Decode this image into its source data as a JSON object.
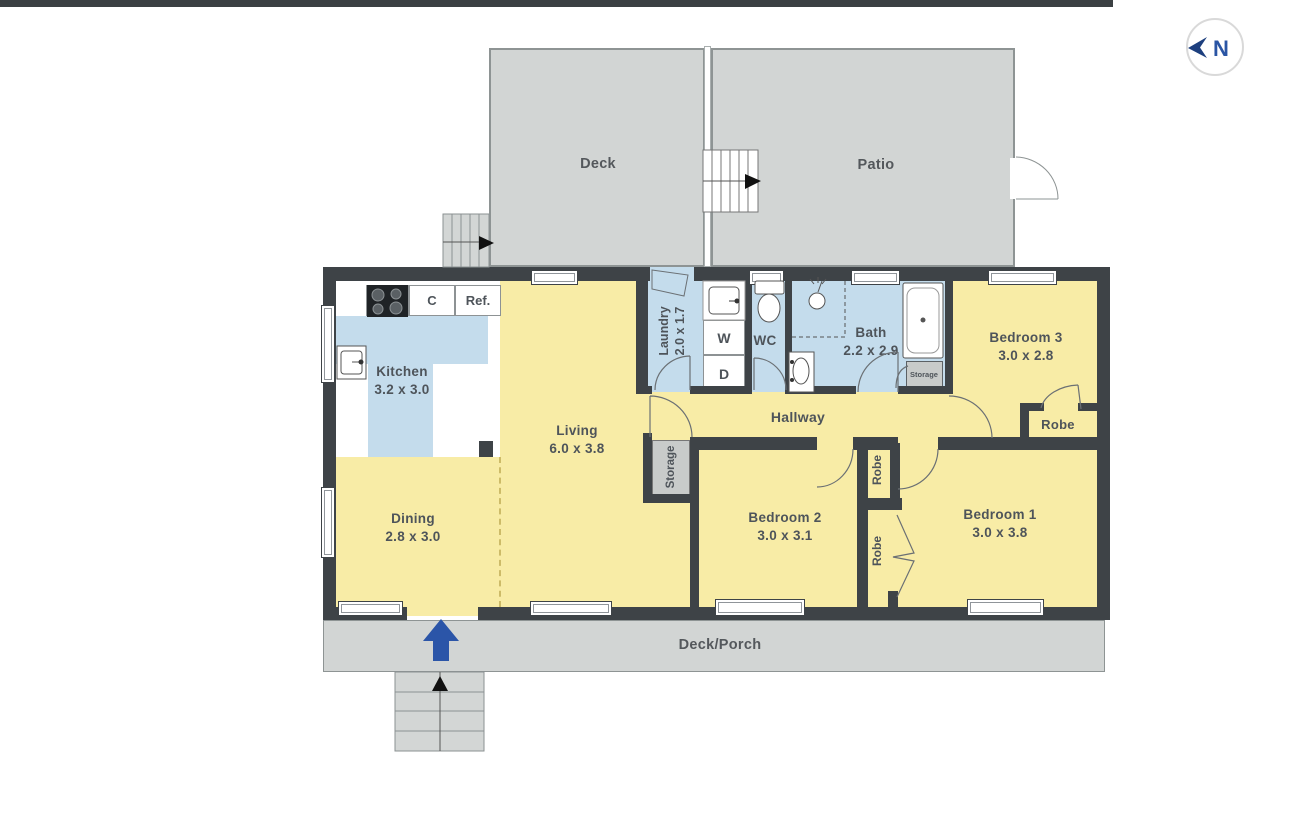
{
  "compass": {
    "label": "N"
  },
  "colors": {
    "room_fill": "#f8eca6",
    "wet_room_fill": "#c4dcec",
    "wall": "#3e4347",
    "outdoor_fill": "#d2d5d4",
    "entry_arrow": "#2b55a8",
    "compass_blue": "#2a55a4"
  },
  "outdoor": {
    "deck": {
      "name": "Deck"
    },
    "patio": {
      "name": "Patio"
    },
    "deck_porch": {
      "name": "Deck/Porch"
    }
  },
  "rooms": {
    "kitchen": {
      "name": "Kitchen",
      "dims": "3.2 x 3.0"
    },
    "living": {
      "name": "Living",
      "dims": "6.0 x 3.8"
    },
    "dining": {
      "name": "Dining",
      "dims": "2.8 x 3.0"
    },
    "laundry": {
      "name": "Laundry",
      "dims": "2.0 x 1.7"
    },
    "wc": {
      "name": "WC"
    },
    "bath": {
      "name": "Bath",
      "dims": "2.2 x 2.9"
    },
    "hallway": {
      "name": "Hallway"
    },
    "bedroom1": {
      "name": "Bedroom 1",
      "dims": "3.0 x 3.8"
    },
    "bedroom2": {
      "name": "Bedroom 2",
      "dims": "3.0 x 3.1"
    },
    "bedroom3": {
      "name": "Bedroom 3",
      "dims": "3.0 x 2.8"
    }
  },
  "closets": {
    "robe_bed3": {
      "label": "Robe"
    },
    "robe_upper": {
      "label": "Robe"
    },
    "robe_lower": {
      "label": "Robe"
    },
    "storage_hall": {
      "label": "Storage"
    },
    "storage_bath": {
      "label": "Storage"
    }
  },
  "fixtures": {
    "cupboard": "C",
    "fridge": "Ref.",
    "washer": "W",
    "dryer": "D"
  }
}
